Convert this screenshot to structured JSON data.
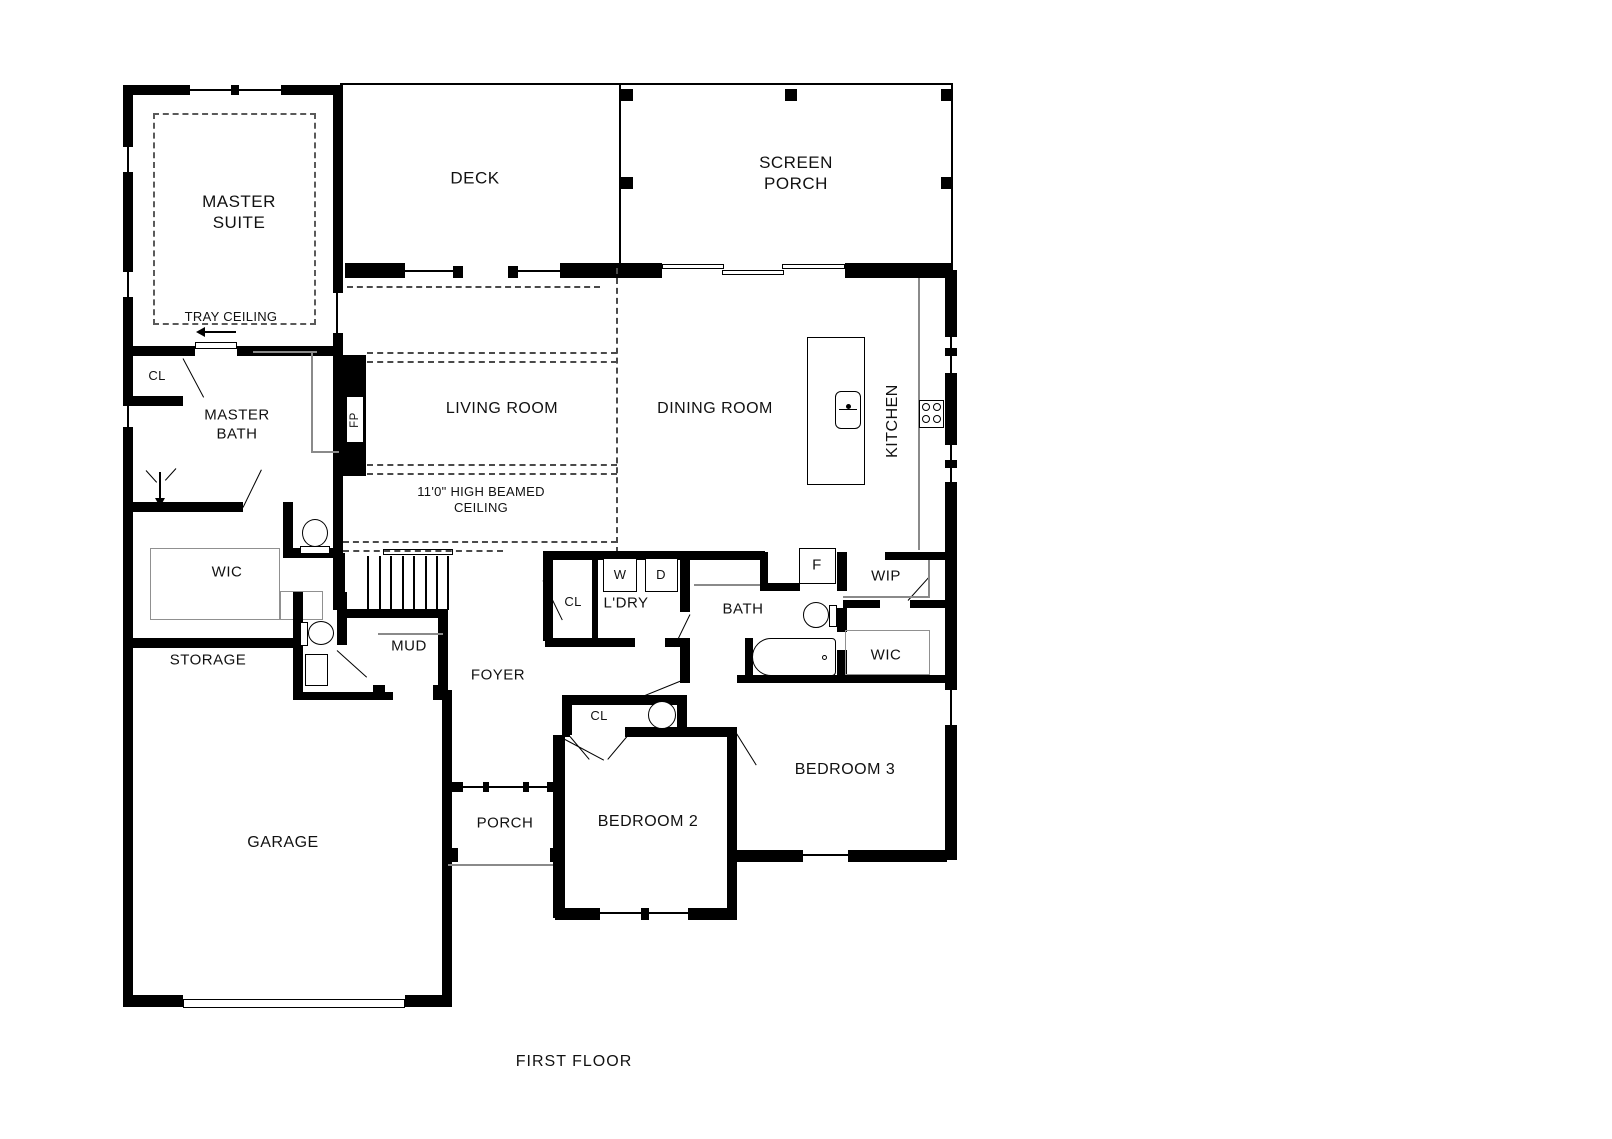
{
  "title": "FIRST FLOOR",
  "colors": {
    "walls": "#000000",
    "background": "#ffffff",
    "thin_lines": "#8a8a8a",
    "dashed_lines": "#4a4a4a"
  },
  "labels": {
    "master_suite": "MASTER SUITE",
    "tray_ceiling": "TRAY CEILING",
    "deck": "DECK",
    "screen_porch": "SCREEN PORCH",
    "living_room": "LIVING ROOM",
    "dining_room": "DINING ROOM",
    "kitchen": "KITCHEN",
    "beamed_ceiling": "11'0\" HIGH BEAMED CEILING",
    "closet_master": "CL",
    "master_bath": "MASTER BATH",
    "wic_master": "WIC",
    "storage": "STORAGE",
    "mud": "MUD",
    "closet_hall": "CL",
    "laundry": "L'DRY",
    "washer": "W",
    "dryer": "D",
    "bath": "BATH",
    "fridge": "F",
    "wip": "WIP",
    "wic_hall": "WIC",
    "foyer": "FOYER",
    "closet_bed2": "CL",
    "garage": "GARAGE",
    "porch": "PORCH",
    "bedroom2": "BEDROOM 2",
    "bedroom3": "BEDROOM 3",
    "fireplace": "FP",
    "floor_title": "FIRST FLOOR"
  },
  "fixtures": [
    "toilet-master",
    "toilet-powder",
    "toilet-hall-bath",
    "bathtub",
    "shower",
    "kitchen-island-sink",
    "stove",
    "fridge",
    "washer",
    "dryer",
    "stairs",
    "corner-sink",
    "vanity",
    "garage-door",
    "sliding-door",
    "pocket-door"
  ]
}
